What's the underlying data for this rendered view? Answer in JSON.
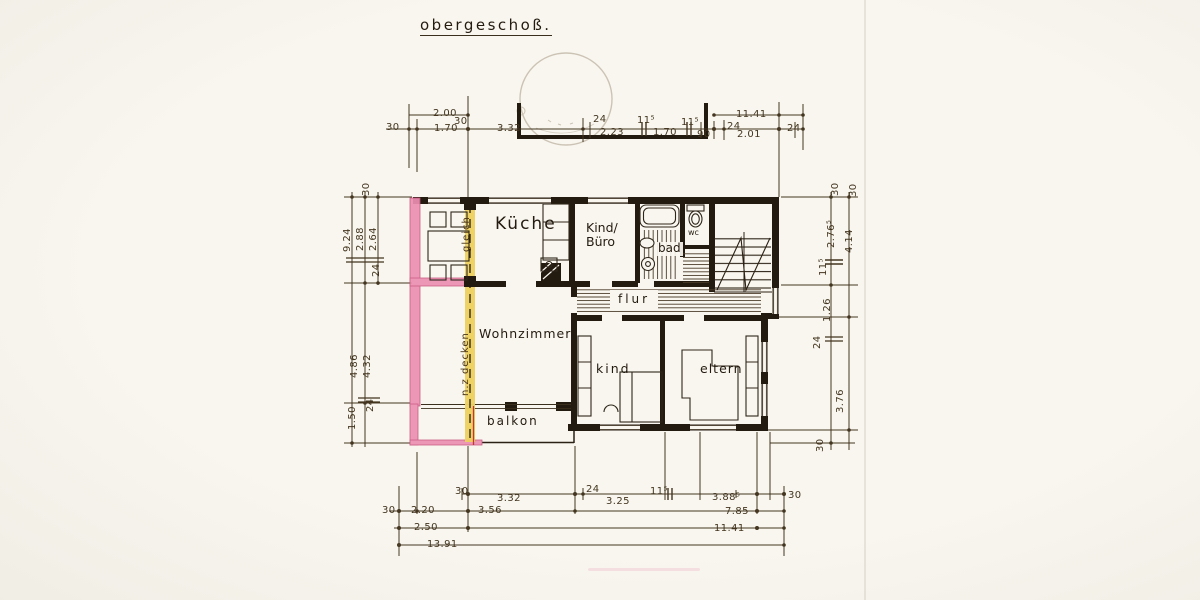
{
  "title": "obergeschoß.",
  "rooms": {
    "kueche": "Küche",
    "kind_buero": "Kind/\nBüro",
    "bad": "bad",
    "wc": "wc",
    "flur": "flur",
    "wohnzimmer": "Wohnzimmer",
    "kind": "kind",
    "eltern": "eltern",
    "balkon": "balkon"
  },
  "annotations": {
    "gleich": "gleich",
    "nz_decken": "n.z decken"
  },
  "dimensions": {
    "top": [
      {
        "value": "30"
      },
      {
        "value": "2.00"
      },
      {
        "value": "1.70"
      },
      {
        "value": "30"
      },
      {
        "value": "3.32"
      },
      {
        "value": "24"
      },
      {
        "value": "2.23"
      },
      {
        "value": "11⁵"
      },
      {
        "value": "1.70"
      },
      {
        "value": "11⁵"
      },
      {
        "value": "90"
      },
      {
        "value": "24"
      },
      {
        "value": "11.41"
      },
      {
        "value": "2.01"
      },
      {
        "value": "24"
      }
    ],
    "left": [
      {
        "value": "30"
      },
      {
        "value": "9.24"
      },
      {
        "value": "2.88"
      },
      {
        "value": "2.64"
      },
      {
        "value": "24"
      },
      {
        "value": "4.86"
      },
      {
        "value": "4.32"
      },
      {
        "value": "1.50"
      },
      {
        "value": "24"
      }
    ],
    "right": [
      {
        "value": "30"
      },
      {
        "value": "30"
      },
      {
        "value": "2.76⁵"
      },
      {
        "value": "4.14"
      },
      {
        "value": "11⁵"
      },
      {
        "value": "1.26"
      },
      {
        "value": "24"
      },
      {
        "value": "3.76"
      },
      {
        "value": "30"
      }
    ],
    "bottom": [
      {
        "value": "30"
      },
      {
        "value": "3.32"
      },
      {
        "value": "24"
      },
      {
        "value": "3.25"
      },
      {
        "value": "11⁵"
      },
      {
        "value": "3.88⁵"
      },
      {
        "value": "30"
      },
      {
        "value": "30"
      },
      {
        "value": "2.20"
      },
      {
        "value": "3.56"
      },
      {
        "value": "7.85"
      },
      {
        "value": "2.50"
      },
      {
        "value": "11.41"
      },
      {
        "value": "13.91"
      }
    ]
  },
  "colors": {
    "paper": "#f8f6ef",
    "wall_ink": "#241b10",
    "dim_text": "#43351f",
    "pink_highlight": "#ec8fb2",
    "yellow_highlight": "#eed05e",
    "red_line": "#c0392b",
    "stamp": "#a2927c"
  }
}
